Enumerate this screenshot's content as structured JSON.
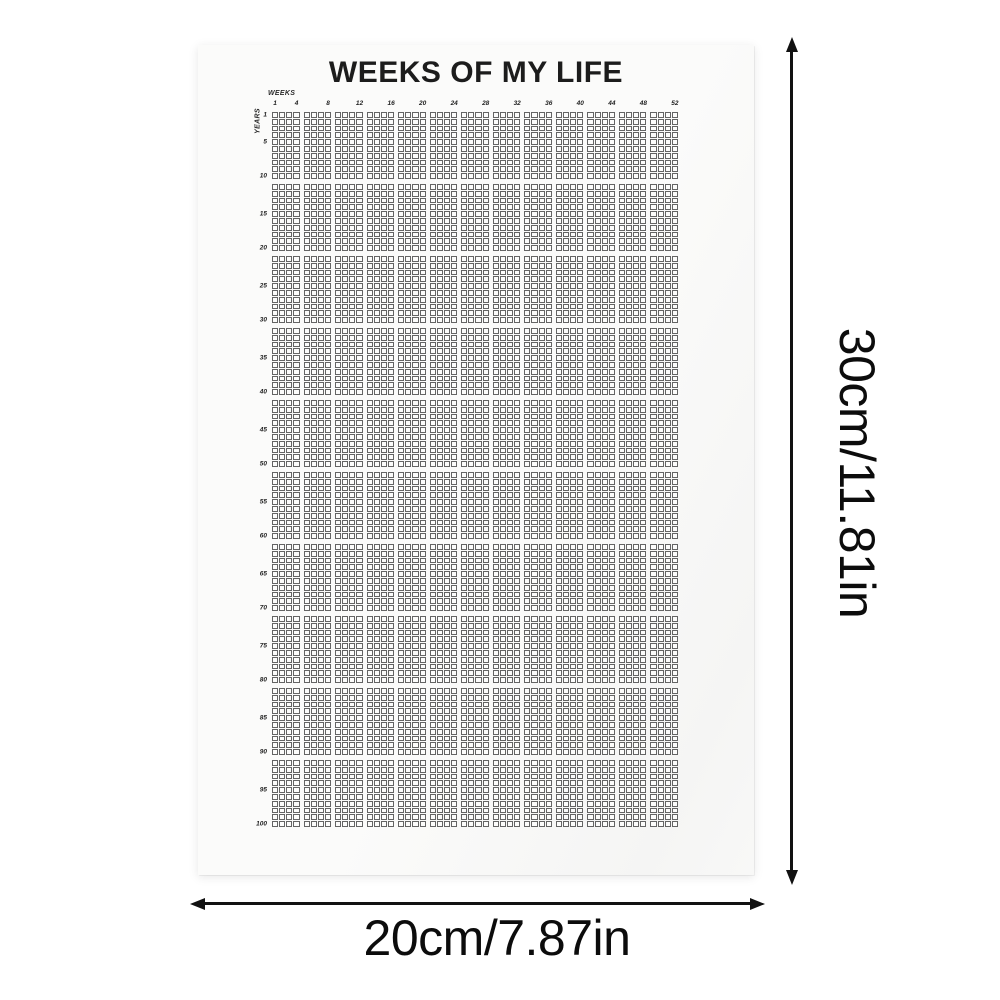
{
  "poster": {
    "title": "WEEKS OF MY LIFE",
    "weeks_axis_label": "WEEKS",
    "years_axis_label": "YEARS",
    "week_labels": [
      "1",
      "4",
      "8",
      "12",
      "16",
      "20",
      "24",
      "28",
      "32",
      "36",
      "40",
      "44",
      "48",
      "52"
    ],
    "year_labels": [
      "1",
      "5",
      "10",
      "15",
      "20",
      "25",
      "30",
      "35",
      "40",
      "45",
      "50",
      "55",
      "60",
      "65",
      "70",
      "75",
      "80",
      "85",
      "90",
      "95",
      "100"
    ],
    "grid": {
      "total_weeks_per_year": 52,
      "total_years": 100,
      "col_blocks": 13,
      "row_blocks": 10,
      "weeks_per_block": 4,
      "years_per_block": 10
    }
  },
  "dimensions": {
    "height_label": "30cm/11.81in",
    "width_label": "20cm/7.87in"
  },
  "colors": {
    "grid_line": "#646464",
    "cell_fill": "#fcfcfb",
    "paper": "#fafaf9",
    "arrow": "#111111",
    "text": "#0c0c0c"
  }
}
